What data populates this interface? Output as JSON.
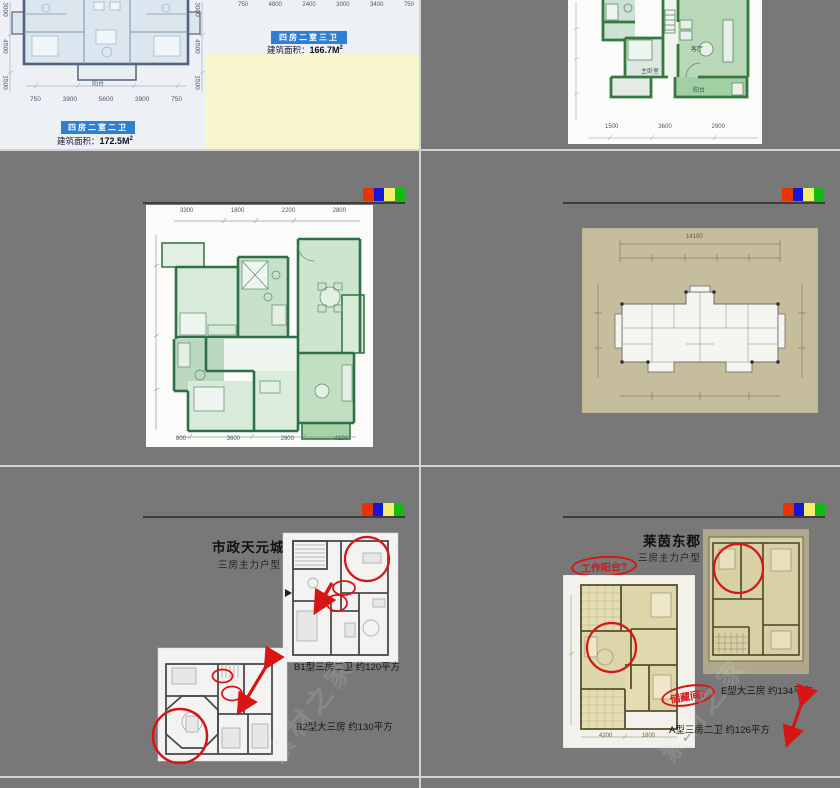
{
  "s1": {
    "label1": "四房二室二卫",
    "area1_prefix": "建筑面积：",
    "area1_value": "172.5M",
    "area1_sup": "2",
    "label2": "四房二室三卫",
    "area2_prefix": "建筑面积：",
    "area2_value": "166.7M",
    "area2_sup": "2",
    "dims_left": [
      "3000",
      "4500",
      "1500"
    ],
    "dims_right": [
      "3000",
      "4500",
      "1500"
    ],
    "dims_bottom": [
      "750",
      "3900",
      "5600",
      "3900",
      "750"
    ],
    "dims_top_strip": [
      "750",
      "4800",
      "2400",
      "3000",
      "3400",
      "750"
    ],
    "balcony_label": "阳台"
  },
  "s2": {
    "label_master": "主卧室",
    "label_living": "客厅",
    "label_balcony": "阳台",
    "dims_bottom": [
      "1500",
      "3600",
      "2900"
    ]
  },
  "s3": {
    "dims_top": [
      "3300",
      "1800",
      "2200",
      "2800"
    ],
    "dims_bottom": [
      "800",
      "3600",
      "2900",
      "4100"
    ]
  },
  "s4": {
    "total_dim": "14100"
  },
  "s5": {
    "title": "市政天元城",
    "subtitle": "三房主力户型",
    "b1_caption": "B1型三房二卫 约120平方",
    "b2_caption": "B2型大三房 约130平方"
  },
  "s6": {
    "title": "莱茵东郡",
    "subtitle": "三房主力户型",
    "note_worktop": "工作阳台?",
    "note_storage": "储藏间?",
    "e_caption": "E型大三房 约134平方",
    "a_caption": "A型三房二卫 约126平方",
    "check_mark": "✓",
    "dims_bottom": [
      "4200",
      "1800"
    ]
  },
  "watermark": "素材之家",
  "colors": {
    "canvas": "#787878",
    "divider": "#d3d3d3",
    "header_line": "#3d3d3d",
    "logo_red": "#e83400",
    "logo_blue": "#1616d6",
    "logo_yellow": "#f2ef70",
    "logo_green": "#12ba12",
    "annotation_red": "#d81515",
    "label_blue": "#2f7fd2",
    "note_yellow": "#f8f6cd"
  }
}
